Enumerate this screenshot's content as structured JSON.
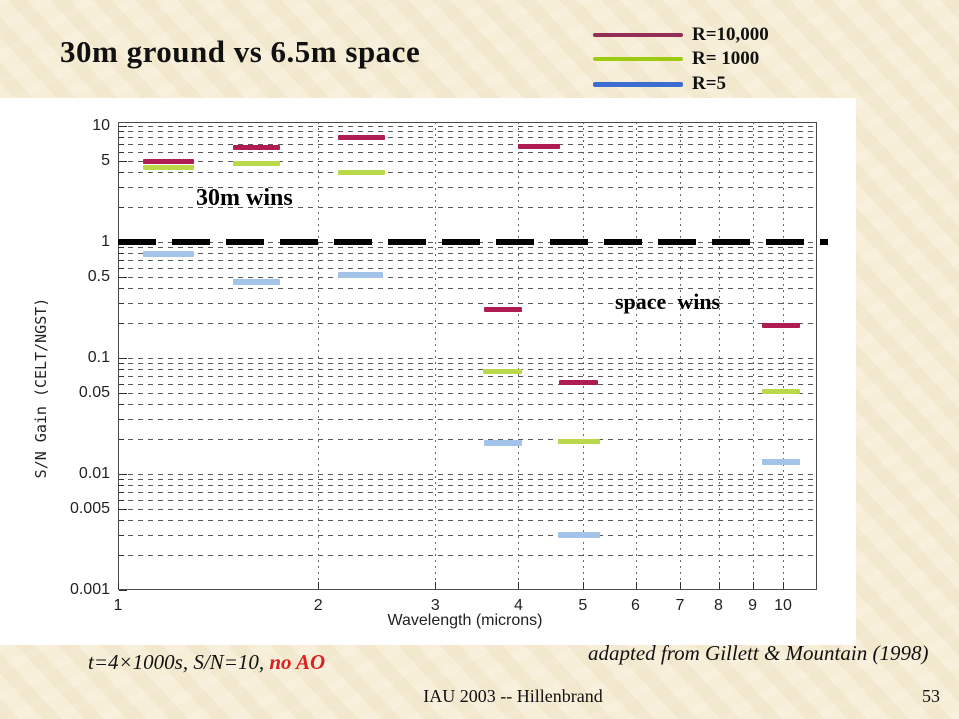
{
  "slide": {
    "title": "30m ground vs 6.5m space",
    "footnote_text": "t=4×1000s, S/N=10, ",
    "footnote_red": "no AO",
    "credit": "adapted from Gillett & Mountain (1998)",
    "footer_center": "IAU 2003 -- Hillenbrand",
    "page_number": "53",
    "colors": {
      "background": "#f6eed7",
      "red_text": "#dd2020"
    }
  },
  "chart_data": {
    "type": "line",
    "description": "Horizontal wavelength-band segments showing S/N gain of 30m ground telescope over 6.5m space telescope, log-log axes",
    "xlabel": "Wavelength (microns)",
    "ylabel": "S/N Gain (CELT/NGST)",
    "xscale": "log",
    "yscale": "log",
    "xlim": [
      1,
      11.25
    ],
    "ylim": [
      0.001,
      10.8
    ],
    "grid": "dashed minor log grid",
    "legend_position": "top-right outside",
    "x_ticks": [
      {
        "value": 1,
        "label": "1"
      },
      {
        "value": 2,
        "label": "2"
      },
      {
        "value": 3,
        "label": "3"
      },
      {
        "value": 4,
        "label": "4"
      },
      {
        "value": 5,
        "label": "5"
      },
      {
        "value": 6,
        "label": "6"
      },
      {
        "value": 7,
        "label": "7"
      },
      {
        "value": 8,
        "label": "8"
      },
      {
        "value": 9,
        "label": "9"
      },
      {
        "value": 10,
        "label": "10"
      }
    ],
    "y_ticks": [
      {
        "value": 10,
        "label": "10"
      },
      {
        "value": 5,
        "label": "5"
      },
      {
        "value": 1,
        "label": "1"
      },
      {
        "value": 0.5,
        "label": "0.5"
      },
      {
        "value": 0.1,
        "label": "0.1"
      },
      {
        "value": 0.05,
        "label": "0.05"
      },
      {
        "value": 0.01,
        "label": "0.01"
      },
      {
        "value": 0.005,
        "label": "0.005"
      },
      {
        "value": 0.001,
        "label": "0.001"
      }
    ],
    "reference_line": {
      "y": 1,
      "style": "thick black dashed",
      "above_label": "30m wins",
      "below_label": "space wins"
    },
    "annotations": [
      {
        "text": "30m wins",
        "x": 1.6,
        "y": 2.4
      },
      {
        "text": "space  wins",
        "x": 5.6,
        "y": 0.28
      }
    ],
    "series": [
      {
        "name": "R=10,000",
        "legend_color": "#932e56",
        "chart_color": "#ae1c52",
        "thickness": 5,
        "segments": [
          {
            "x1": 1.09,
            "x2": 1.3,
            "y": 4.9
          },
          {
            "x1": 1.49,
            "x2": 1.75,
            "y": 6.5
          },
          {
            "x1": 2.14,
            "x2": 2.52,
            "y": 8.0
          },
          {
            "x1": 4.0,
            "x2": 4.62,
            "y": 6.6
          },
          {
            "x1": 3.55,
            "x2": 4.05,
            "y": 0.26
          },
          {
            "x1": 4.6,
            "x2": 5.27,
            "y": 0.061
          },
          {
            "x1": 9.3,
            "x2": 10.6,
            "y": 0.19
          }
        ]
      },
      {
        "name": "R= 1000",
        "legend_color": "#9ccb12",
        "chart_color": "#b9d84a",
        "thickness": 5,
        "segments": [
          {
            "x1": 1.09,
            "x2": 1.3,
            "y": 4.35
          },
          {
            "x1": 1.49,
            "x2": 1.75,
            "y": 4.7
          },
          {
            "x1": 2.14,
            "x2": 2.52,
            "y": 4.0
          },
          {
            "x1": 3.54,
            "x2": 4.05,
            "y": 0.076
          },
          {
            "x1": 4.59,
            "x2": 5.3,
            "y": 0.019
          },
          {
            "x1": 9.3,
            "x2": 10.6,
            "y": 0.051
          }
        ]
      },
      {
        "name": "R=5",
        "legend_color": "#3c6ed2",
        "chart_color": "#a3c4e8",
        "thickness": 6,
        "segments": [
          {
            "x1": 1.09,
            "x2": 1.3,
            "y": 0.78
          },
          {
            "x1": 1.49,
            "x2": 1.75,
            "y": 0.45
          },
          {
            "x1": 2.14,
            "x2": 2.5,
            "y": 0.52
          },
          {
            "x1": 3.55,
            "x2": 4.05,
            "y": 0.0185
          },
          {
            "x1": 4.59,
            "x2": 5.3,
            "y": 0.003
          },
          {
            "x1": 9.3,
            "x2": 10.6,
            "y": 0.0127
          }
        ]
      }
    ]
  }
}
